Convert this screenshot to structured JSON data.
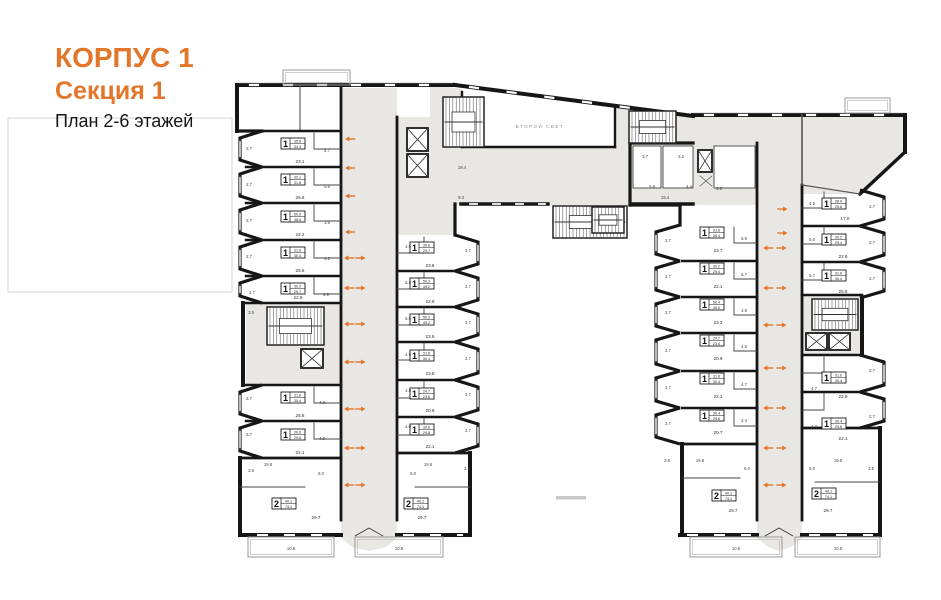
{
  "header": {
    "building": "КОРПУС 1",
    "section": "Секция 1",
    "plan_caption": "План 2-6 этажей"
  },
  "plan": {
    "second_light_label": "ВТОРОЙ СВЕТ",
    "colors": {
      "accent": "#e2762b",
      "wall": "#161616",
      "thin": "#444444",
      "corridor": "#e8e7e4",
      "room": "#ffffff",
      "faint": "#d8d8d8",
      "tiny_text": "#3c3c3c",
      "muted_text": "#8a8a8a"
    },
    "apartments": [
      {
        "x": 281,
        "y": 138,
        "r": "1",
        "a1": "35.6",
        "a2": "34.3",
        "ra": "23.1",
        "ax": 300,
        "ay": 163
      },
      {
        "x": 281,
        "y": 174,
        "r": "1",
        "a1": "32.1",
        "a2": "31.8",
        "ra": "25.6",
        "ax": 300,
        "ay": 199
      },
      {
        "x": 281,
        "y": 211,
        "r": "1",
        "a1": "50.0",
        "a2": "48.6",
        "ra": "22.2",
        "ax": 300,
        "ay": 236
      },
      {
        "x": 281,
        "y": 247,
        "r": "1",
        "a1": "31.6",
        "a2": "30.4",
        "ra": "25.6",
        "ax": 300,
        "ay": 272
      },
      {
        "x": 281,
        "y": 283,
        "r": "1",
        "a1": "30.2",
        "a2": "29.7",
        "ra": "22.9",
        "ax": 298,
        "ay": 299
      },
      {
        "x": 281,
        "y": 392,
        "r": "1",
        "a1": "31.6",
        "a2": "30.4",
        "ra": "25.8",
        "ax": 300,
        "ay": 417
      },
      {
        "x": 281,
        "y": 429,
        "r": "1",
        "a1": "30.6",
        "a2": "29.8",
        "ra": "22.1",
        "ax": 300,
        "ay": 454
      },
      {
        "x": 272,
        "y": 498,
        "r": "2",
        "a1": "40.1",
        "a2": "74.1",
        "ra": "29.7",
        "ax": 316,
        "ay": 519
      },
      {
        "x": 410,
        "y": 242,
        "r": "1",
        "a1": "30.6",
        "a2": "29.7",
        "ra": "23.8",
        "ax": 430,
        "ay": 267
      },
      {
        "x": 410,
        "y": 278,
        "r": "1",
        "a1": "50.3",
        "a2": "49.2",
        "ra": "22.9",
        "ax": 430,
        "ay": 303
      },
      {
        "x": 410,
        "y": 314,
        "r": "1",
        "a1": "50.3",
        "a2": "49.2",
        "ra": "23.9",
        "ax": 430,
        "ay": 338
      },
      {
        "x": 410,
        "y": 350,
        "r": "1",
        "a1": "31.6",
        "a2": "30.4",
        "ra": "23.8",
        "ax": 430,
        "ay": 375
      },
      {
        "x": 410,
        "y": 388,
        "r": "1",
        "a1": "24.7",
        "a2": "23.6",
        "ra": "20.9",
        "ax": 430,
        "ay": 412
      },
      {
        "x": 410,
        "y": 424,
        "r": "1",
        "a1": "30.6",
        "a2": "29.8",
        "ra": "22.1",
        "ax": 430,
        "ay": 448
      },
      {
        "x": 404,
        "y": 498,
        "r": "2",
        "a1": "40.1",
        "a2": "74.1",
        "ra": "29.7",
        "ax": 422,
        "ay": 519
      },
      {
        "x": 700,
        "y": 227,
        "r": "1",
        "a1": "31.6",
        "a2": "30.4",
        "ra": "23.7",
        "ax": 718,
        "ay": 252
      },
      {
        "x": 700,
        "y": 263,
        "r": "1",
        "a1": "30.2",
        "a2": "29.4",
        "ra": "22.1",
        "ax": 718,
        "ay": 288
      },
      {
        "x": 700,
        "y": 299,
        "r": "1",
        "a1": "50.4",
        "a2": "49.0",
        "ra": "23.3",
        "ax": 718,
        "ay": 324
      },
      {
        "x": 700,
        "y": 335,
        "r": "1",
        "a1": "24.7",
        "a2": "23.6",
        "ra": "20.9",
        "ax": 718,
        "ay": 360
      },
      {
        "x": 700,
        "y": 373,
        "r": "1",
        "a1": "31.6",
        "a2": "30.4",
        "ra": "22.1",
        "ax": 718,
        "ay": 398
      },
      {
        "x": 700,
        "y": 410,
        "r": "1",
        "a1": "30.4",
        "a2": "29.6",
        "ra": "20.7",
        "ax": 718,
        "ay": 434
      },
      {
        "x": 712,
        "y": 490,
        "r": "2",
        "a1": "40.1",
        "a2": "74.1",
        "ra": "29.7",
        "ax": 733,
        "ay": 512
      },
      {
        "x": 822,
        "y": 198,
        "r": "1",
        "a1": "26.9",
        "a2": "25.8",
        "ra": "17.0",
        "ax": 845,
        "ay": 220
      },
      {
        "x": 822,
        "y": 234,
        "r": "1",
        "a1": "30.2",
        "a2": "29.4",
        "ra": "22.9",
        "ax": 843,
        "ay": 258
      },
      {
        "x": 822,
        "y": 270,
        "r": "1",
        "a1": "31.6",
        "a2": "30.4",
        "ra": "25.8",
        "ax": 843,
        "ay": 293
      },
      {
        "x": 822,
        "y": 372,
        "r": "1",
        "a1": "31.6",
        "a2": "30.4",
        "ra": "22.9",
        "ax": 843,
        "ay": 398
      },
      {
        "x": 822,
        "y": 418,
        "r": "1",
        "a1": "30.4",
        "a2": "29.6",
        "ra": "22.1",
        "ax": 843,
        "ay": 440
      },
      {
        "x": 812,
        "y": 488,
        "r": "2",
        "a1": "40.1",
        "a2": "74.1",
        "ra": "29.7",
        "ax": 828,
        "ay": 512
      }
    ],
    "arrows": [
      {
        "x": 345,
        "y": 139,
        "d": "l"
      },
      {
        "x": 345,
        "y": 168,
        "d": "l"
      },
      {
        "x": 345,
        "y": 196,
        "d": "l"
      },
      {
        "x": 345,
        "y": 232,
        "d": "l"
      },
      {
        "x": 344,
        "y": 258,
        "d": "l"
      },
      {
        "x": 356,
        "y": 258,
        "d": "r"
      },
      {
        "x": 344,
        "y": 288,
        "d": "l"
      },
      {
        "x": 356,
        "y": 288,
        "d": "r"
      },
      {
        "x": 344,
        "y": 324,
        "d": "l"
      },
      {
        "x": 356,
        "y": 324,
        "d": "r"
      },
      {
        "x": 344,
        "y": 362,
        "d": "l"
      },
      {
        "x": 356,
        "y": 362,
        "d": "r"
      },
      {
        "x": 344,
        "y": 409,
        "d": "l"
      },
      {
        "x": 356,
        "y": 409,
        "d": "r"
      },
      {
        "x": 344,
        "y": 448,
        "d": "l"
      },
      {
        "x": 356,
        "y": 448,
        "d": "r"
      },
      {
        "x": 344,
        "y": 485,
        "d": "l"
      },
      {
        "x": 356,
        "y": 485,
        "d": "r"
      },
      {
        "x": 778,
        "y": 209,
        "d": "r"
      },
      {
        "x": 778,
        "y": 233,
        "d": "r"
      },
      {
        "x": 763,
        "y": 248,
        "d": "l"
      },
      {
        "x": 777,
        "y": 248,
        "d": "r"
      },
      {
        "x": 763,
        "y": 288,
        "d": "l"
      },
      {
        "x": 777,
        "y": 288,
        "d": "r"
      },
      {
        "x": 763,
        "y": 325,
        "d": "l"
      },
      {
        "x": 777,
        "y": 325,
        "d": "r"
      },
      {
        "x": 763,
        "y": 368,
        "d": "l"
      },
      {
        "x": 777,
        "y": 368,
        "d": "r"
      },
      {
        "x": 763,
        "y": 408,
        "d": "l"
      },
      {
        "x": 777,
        "y": 408,
        "d": "r"
      },
      {
        "x": 763,
        "y": 448,
        "d": "l"
      },
      {
        "x": 777,
        "y": 448,
        "d": "r"
      },
      {
        "x": 763,
        "y": 485,
        "d": "l"
      },
      {
        "x": 777,
        "y": 485,
        "d": "r"
      }
    ],
    "tiny_numbers": [
      {
        "x": 249,
        "y": 150,
        "t": "2.7"
      },
      {
        "x": 249,
        "y": 186,
        "t": "2.7"
      },
      {
        "x": 249,
        "y": 222,
        "t": "2.7"
      },
      {
        "x": 249,
        "y": 258,
        "t": "2.7"
      },
      {
        "x": 252,
        "y": 294,
        "t": "2.7"
      },
      {
        "x": 251,
        "y": 314,
        "t": "3.5"
      },
      {
        "x": 249,
        "y": 400,
        "t": "2.7"
      },
      {
        "x": 249,
        "y": 436,
        "t": "2.7"
      },
      {
        "x": 251,
        "y": 472,
        "t": "3.5"
      },
      {
        "x": 468,
        "y": 252,
        "t": "2.7"
      },
      {
        "x": 468,
        "y": 288,
        "t": "2.7"
      },
      {
        "x": 468,
        "y": 324,
        "t": "2.7"
      },
      {
        "x": 468,
        "y": 360,
        "t": "2.7"
      },
      {
        "x": 468,
        "y": 396,
        "t": "2.7"
      },
      {
        "x": 468,
        "y": 432,
        "t": "2.7"
      },
      {
        "x": 467,
        "y": 470,
        "t": "3.5"
      },
      {
        "x": 668,
        "y": 242,
        "t": "2.7"
      },
      {
        "x": 668,
        "y": 278,
        "t": "2.7"
      },
      {
        "x": 668,
        "y": 314,
        "t": "2.7"
      },
      {
        "x": 668,
        "y": 352,
        "t": "2.7"
      },
      {
        "x": 668,
        "y": 389,
        "t": "2.7"
      },
      {
        "x": 668,
        "y": 425,
        "t": "2.7"
      },
      {
        "x": 667,
        "y": 462,
        "t": "3.5"
      },
      {
        "x": 872,
        "y": 208,
        "t": "2.7"
      },
      {
        "x": 872,
        "y": 244,
        "t": "2.7"
      },
      {
        "x": 872,
        "y": 280,
        "t": "2.7"
      },
      {
        "x": 872,
        "y": 372,
        "t": "2.7"
      },
      {
        "x": 872,
        "y": 418,
        "t": "2.7"
      },
      {
        "x": 871,
        "y": 470,
        "t": "3.5"
      },
      {
        "x": 327,
        "y": 152,
        "t": "4.7"
      },
      {
        "x": 327,
        "y": 188,
        "t": "5.6"
      },
      {
        "x": 327,
        "y": 224,
        "t": "3.9"
      },
      {
        "x": 327,
        "y": 260,
        "t": "4.2"
      },
      {
        "x": 326,
        "y": 296,
        "t": "3.9"
      },
      {
        "x": 322,
        "y": 404,
        "t": "4.9"
      },
      {
        "x": 322,
        "y": 440,
        "t": "4.0"
      },
      {
        "x": 321,
        "y": 475,
        "t": "6.0"
      },
      {
        "x": 408,
        "y": 248,
        "t": "4.5"
      },
      {
        "x": 408,
        "y": 284,
        "t": "5.8"
      },
      {
        "x": 408,
        "y": 320,
        "t": "5.6"
      },
      {
        "x": 408,
        "y": 356,
        "t": "4.5"
      },
      {
        "x": 408,
        "y": 392,
        "t": "4.8"
      },
      {
        "x": 408,
        "y": 428,
        "t": "4.0"
      },
      {
        "x": 413,
        "y": 475,
        "t": "6.0"
      },
      {
        "x": 744,
        "y": 240,
        "t": "5.6"
      },
      {
        "x": 744,
        "y": 276,
        "t": "5.7"
      },
      {
        "x": 744,
        "y": 312,
        "t": "4.8"
      },
      {
        "x": 744,
        "y": 348,
        "t": "4.5"
      },
      {
        "x": 744,
        "y": 386,
        "t": "4.7"
      },
      {
        "x": 744,
        "y": 422,
        "t": "4.4"
      },
      {
        "x": 747,
        "y": 470,
        "t": "6.0"
      },
      {
        "x": 812,
        "y": 205,
        "t": "4.5"
      },
      {
        "x": 812,
        "y": 241,
        "t": "5.6"
      },
      {
        "x": 812,
        "y": 277,
        "t": "5.7"
      },
      {
        "x": 814,
        "y": 390,
        "t": "4.7"
      },
      {
        "x": 814,
        "y": 428,
        "t": "4.4"
      },
      {
        "x": 812,
        "y": 470,
        "t": "6.0"
      },
      {
        "x": 645,
        "y": 158,
        "t": "3.7"
      },
      {
        "x": 652,
        "y": 188,
        "t": "5.9"
      },
      {
        "x": 681,
        "y": 158,
        "t": "2.2"
      },
      {
        "x": 689,
        "y": 188,
        "t": "4.4"
      },
      {
        "x": 719,
        "y": 190,
        "t": "5.6"
      },
      {
        "x": 462,
        "y": 169,
        "t": "19.4"
      },
      {
        "x": 461,
        "y": 199,
        "t": "9.3"
      },
      {
        "x": 665,
        "y": 199,
        "t": "19.4"
      },
      {
        "x": 268,
        "y": 466,
        "t": "19.8"
      },
      {
        "x": 428,
        "y": 466,
        "t": "19.8"
      },
      {
        "x": 700,
        "y": 462,
        "t": "19.8"
      },
      {
        "x": 838,
        "y": 462,
        "t": "19.8"
      },
      {
        "x": 291,
        "y": 550,
        "t": "10.6"
      },
      {
        "x": 399,
        "y": 550,
        "t": "10.6"
      },
      {
        "x": 736,
        "y": 550,
        "t": "10.6"
      },
      {
        "x": 838,
        "y": 550,
        "t": "10.6"
      }
    ],
    "stairs": [
      {
        "x": 267,
        "y": 307,
        "w": 57,
        "h": 38,
        "name": "left-wing-stair"
      },
      {
        "x": 443,
        "y": 97,
        "w": 41,
        "h": 50,
        "name": "connector-left-stair"
      },
      {
        "x": 629,
        "y": 111,
        "w": 47,
        "h": 32,
        "name": "connector-right-stair"
      },
      {
        "x": 553,
        "y": 206,
        "w": 74,
        "h": 32,
        "name": "courtyard-stair"
      },
      {
        "x": 592,
        "y": 207,
        "w": 32,
        "h": 26,
        "name": "entry-stair"
      },
      {
        "x": 812,
        "y": 299,
        "w": 46,
        "h": 31,
        "name": "right-wing-stair"
      }
    ],
    "elevators": [
      {
        "x": 407,
        "y": 128,
        "w": 21,
        "h": 23
      },
      {
        "x": 407,
        "y": 154,
        "w": 21,
        "h": 23
      },
      {
        "x": 301,
        "y": 349,
        "w": 22,
        "h": 19
      },
      {
        "x": 698,
        "y": 150,
        "w": 14,
        "h": 22
      },
      {
        "x": 806,
        "y": 333,
        "w": 21,
        "h": 17
      },
      {
        "x": 829,
        "y": 333,
        "w": 21,
        "h": 17
      }
    ]
  }
}
